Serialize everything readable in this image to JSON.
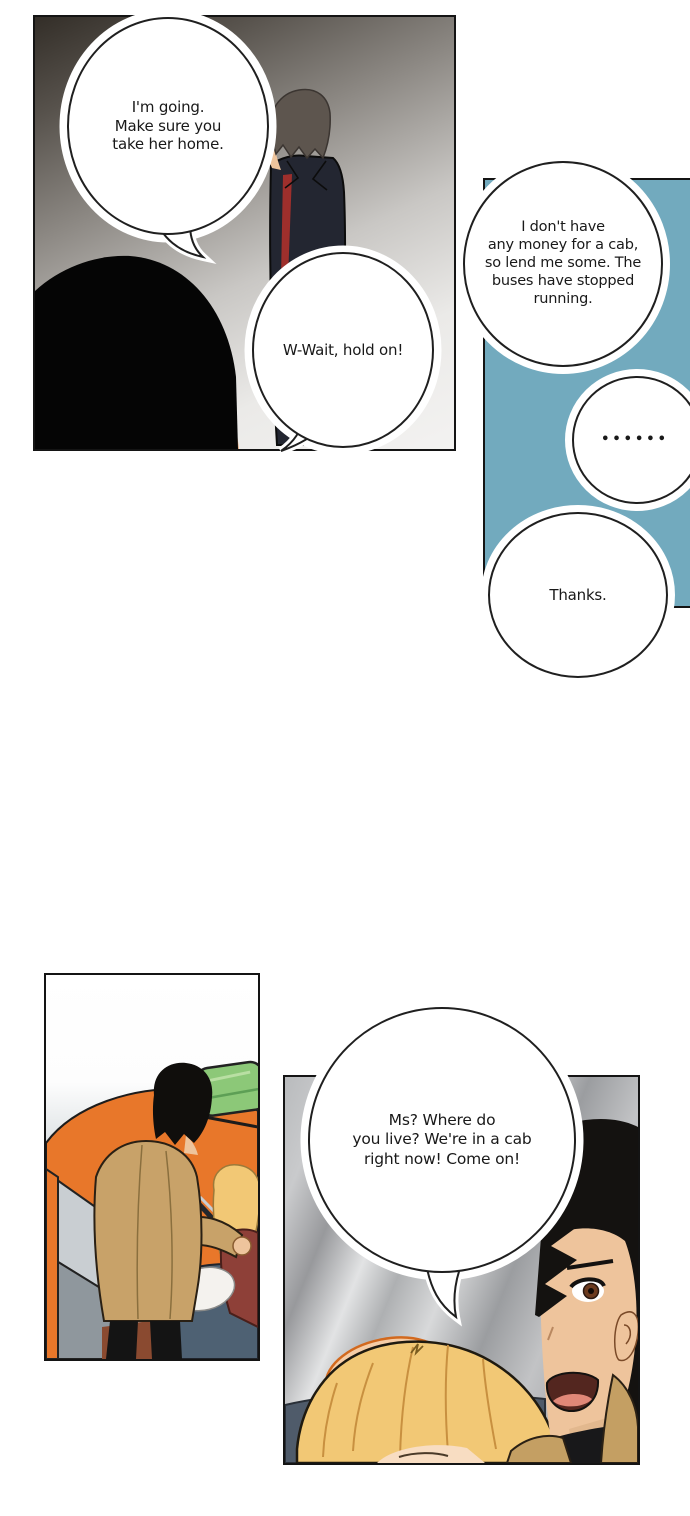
{
  "comic": {
    "bubbles": {
      "going_home": {
        "lines": [
          "I'm going.",
          "Make sure you",
          "take her home."
        ]
      },
      "wait": {
        "lines": [
          "W-Wait, hold on!"
        ]
      },
      "no_money": {
        "lines": [
          "I don't have",
          "any money for a cab,",
          "so lend me some. The",
          "buses have stopped",
          "running."
        ]
      },
      "silence": {
        "lines": [
          "••••••"
        ]
      },
      "thanks": {
        "lines": [
          "Thanks."
        ]
      },
      "where_live": {
        "lines": [
          "Ms? Where do",
          "you live? We're in a cab",
          "right now! Come on!"
        ]
      }
    },
    "colors": {
      "panel_border": "#141414",
      "teal_panel_bg": "#72aabe",
      "taxi_orange": "#e8772a",
      "taxi_sign_green": "#8cc878",
      "jacket_tan": "#c8a269",
      "hair_black": "#141210",
      "hair_blonde": "#f2c875",
      "dress_maroon": "#8e4038",
      "skin": "#eec49c",
      "seat_blue_grey": "#4e6173",
      "bubble_fill": "#ffffff",
      "bubble_stroke": "#1f1f1f"
    }
  }
}
